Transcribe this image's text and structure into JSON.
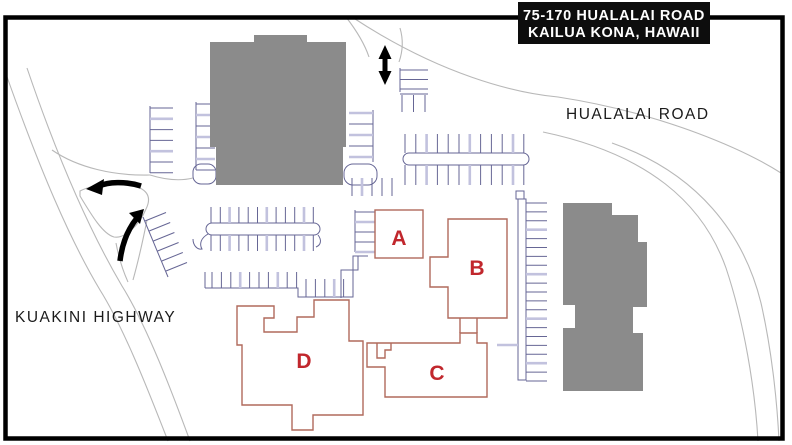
{
  "map": {
    "title_line1": "75-170 HUALALAI ROAD",
    "title_line2": "KAILUA KONA, HAWAII",
    "road_labels": {
      "hualalai": "HUALALAI ROAD",
      "kuakini": "KUAKINI HIGHWAY"
    },
    "buildings": {
      "a": "A",
      "b": "B",
      "c": "C",
      "d": "D"
    }
  },
  "colors": {
    "background": "#ffffff",
    "frame": "#000000",
    "titlebox-bg": "#0d0d0d",
    "titlebox-text": "#ffffff",
    "building-gray": "#8b8b8b",
    "road": "#b8b8b8",
    "parking": "#666695",
    "parking-light": "#c2c2de",
    "outline-red": "#b06a5c",
    "letter-red": "#c1272d",
    "label-text": "#1b1b1b",
    "arrow": "#000000"
  }
}
